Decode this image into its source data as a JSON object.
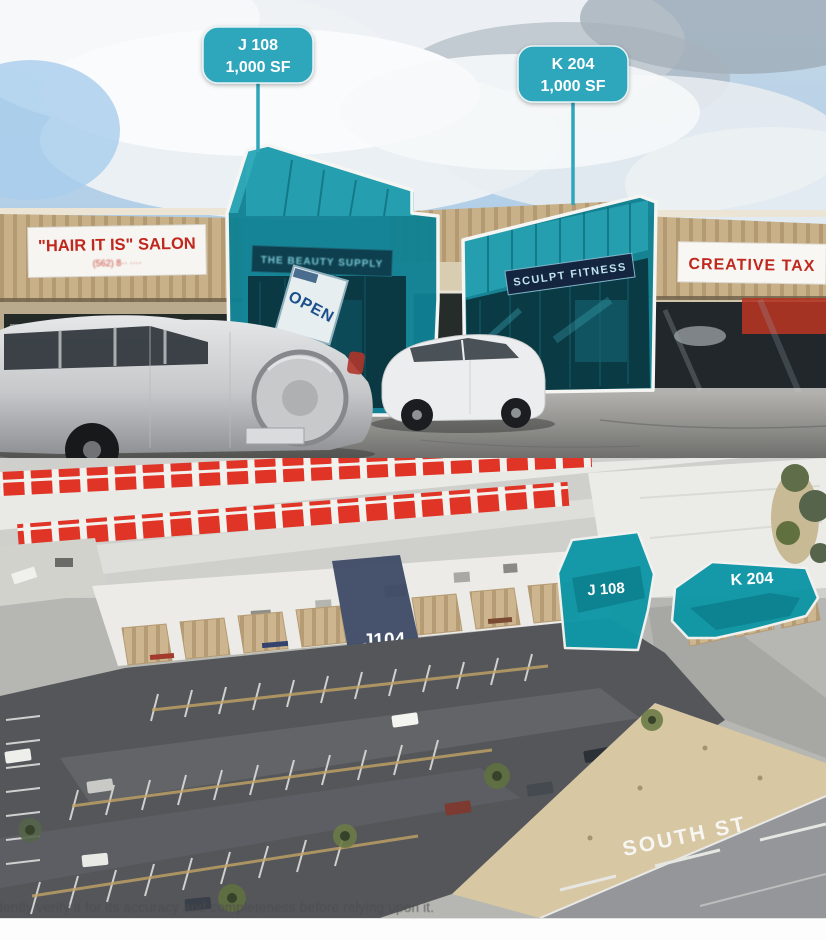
{
  "callouts": [
    {
      "unit": "J 108",
      "size": "1,000 SF"
    },
    {
      "unit": "K 204",
      "size": "1,000 SF"
    }
  ],
  "street_photo": {
    "signs": {
      "salon": "\"HAIR IT IS\" SALON",
      "salon_phone": "(562) 8·· ····",
      "beauty_supply": "THE BEAUTY SUPPLY",
      "open": "OPEN",
      "fitness": "SCULPT FITNESS",
      "tax": "CREATIVE TAX"
    }
  },
  "aerial_photo": {
    "labels": {
      "j104": "J104",
      "j108": "J 108",
      "k204": "K 204",
      "street": "SOUTH ST"
    },
    "disclaimer": "independently verify it for its accuracy and completeness before relying upon it."
  },
  "colors": {
    "callout_teal": "#2fa6bc",
    "unit_teal": "#0f8194",
    "unit_teal_light": "#26a0b0",
    "aerial_teal": "#0f97a6",
    "navy_band": "#3e4a66",
    "sign_red": "#c0271d",
    "marker_red": "#e03427"
  }
}
